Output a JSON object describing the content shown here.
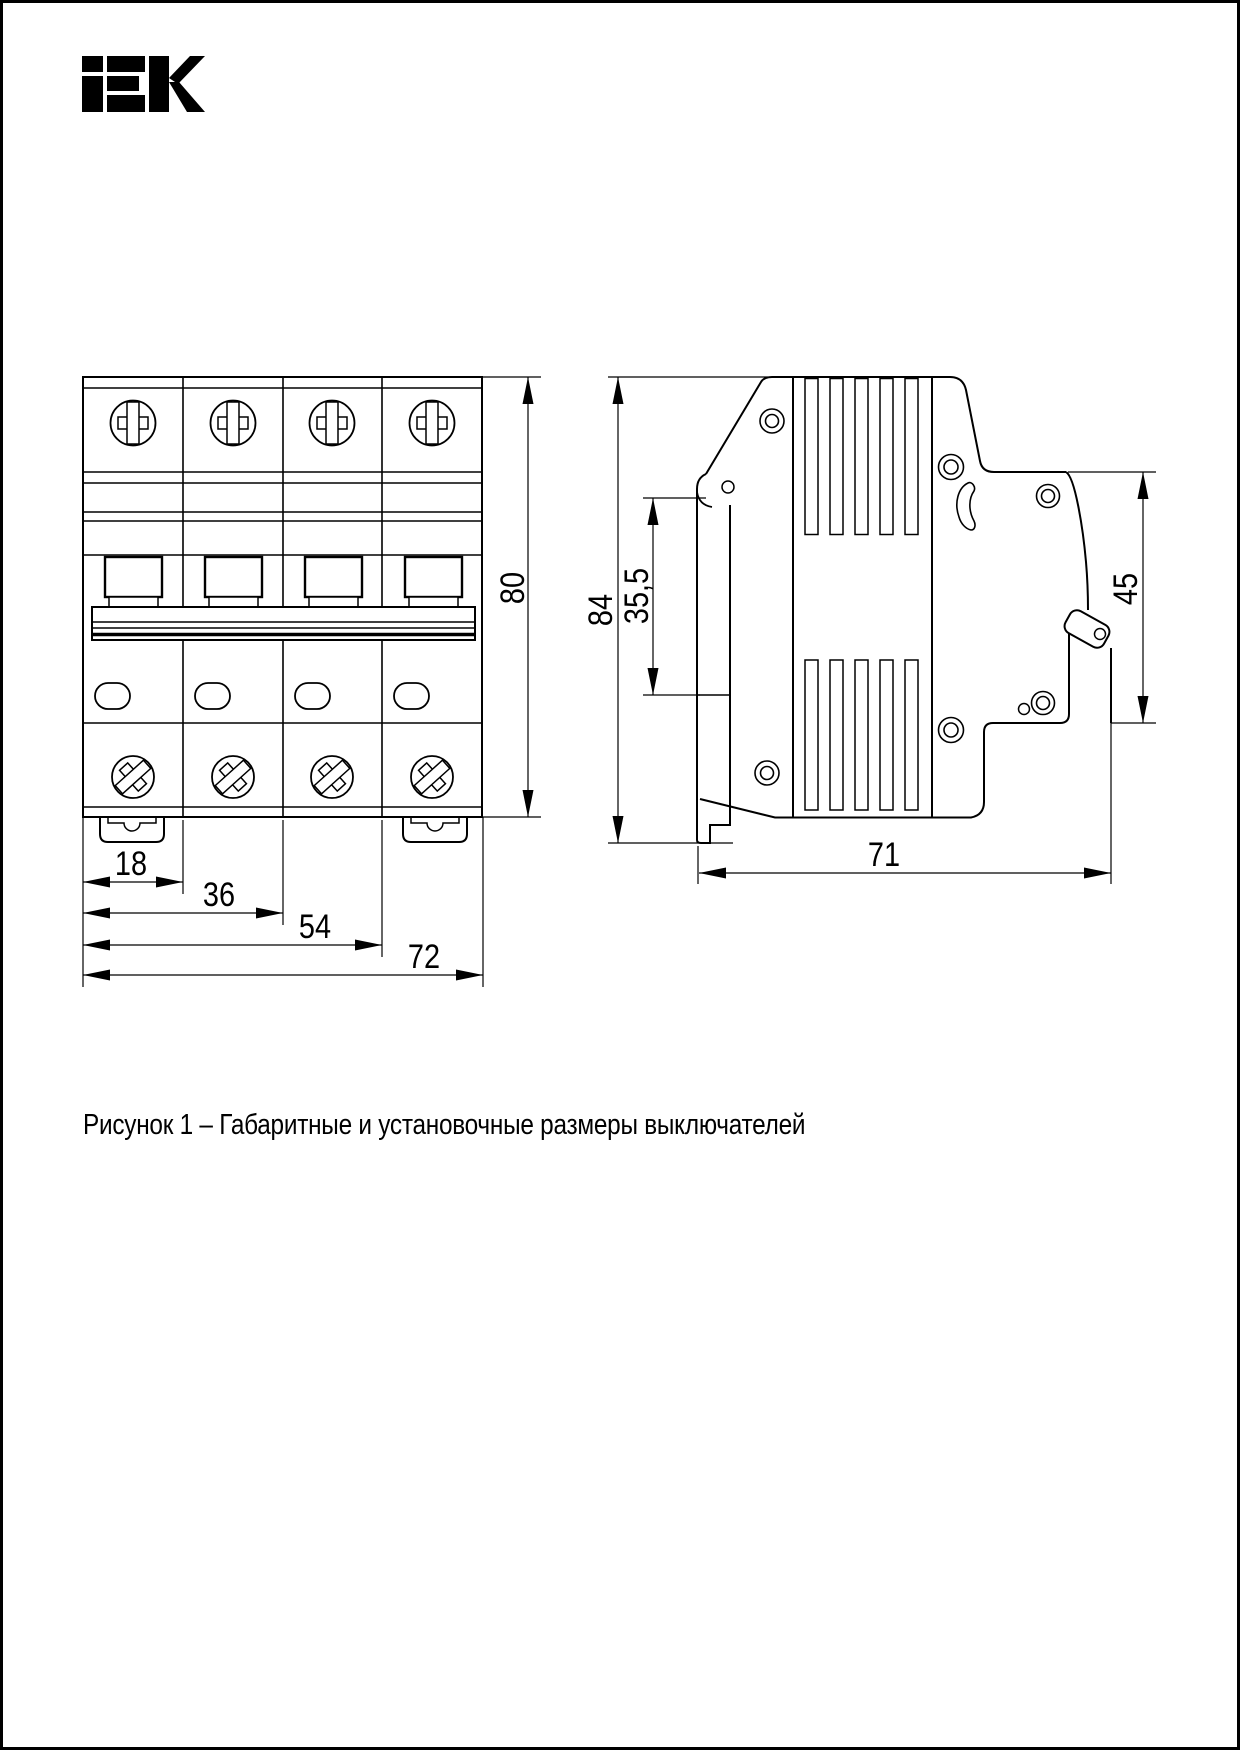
{
  "page": {
    "background": "#ffffff",
    "border_color": "#000000"
  },
  "logo": {
    "text": "IEK",
    "color": "#000000"
  },
  "figure": {
    "caption": "Рисунок 1 – Габаритные и установочные размеры выключателей"
  },
  "dimensions": {
    "front_height": "80",
    "pole_pitch": "18",
    "two_pole_width": "36",
    "three_pole_width": "54",
    "total_width": "72",
    "side_height": "84",
    "rail_zone_height": "35,5",
    "front_section_height": "45",
    "depth": "71"
  }
}
